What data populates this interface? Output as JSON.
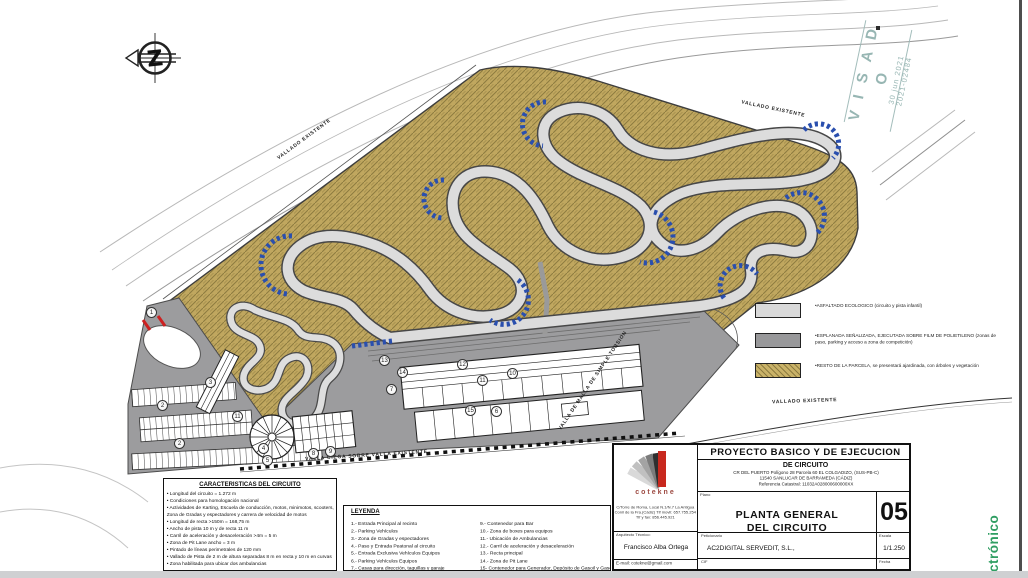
{
  "stamp": {
    "title": "V I S A D O",
    "date": "30 jun 2021",
    "number": "2021-02484"
  },
  "side_text": "ctrónico",
  "fence_labels": {
    "top_left": "VALLADO  EXISTENTE",
    "top_right": "VALLADO  EXISTENTE",
    "right": "VALLADO  EXISTENTE",
    "diagonal": "VALLA  DE  MALLA  DE  SIMPLE  TORSION",
    "bottom": "VALLA  CIEGA  SOBRE  VALLA  EXISTENTE"
  },
  "characteristics": {
    "title": "CARACTERISTICAS DEL CIRCUITO",
    "items": [
      "• Longitud del circuito = 1.272 m",
      "• Condiciones para homologación nacional",
      "• Actividades de Karting, Escuela de conducción, motos, minimotos, scooters, Zona de Gradas y espectadores y carrera de velocidad de motos",
      "• Longitud de recta >150m = 168,75 m",
      "• Ancho de pista 10 m y de recta 11 m",
      "• Carril de aceleración y desaceleración >4m = 5 m",
      "• Zona de Pit Lane ancho = 3 m",
      "• Pintado de líneas perimetrales de 120 mm",
      "• Vallado de Pista de 2 m de altura separadas 8 m en recta y 10 m en curvas",
      "• Zona habilitada para ubicar dos ambulancias"
    ]
  },
  "leyenda": {
    "title": "LEYENDA",
    "left": [
      "1.- Entrada Principal al recinto",
      "2.- Parking Vehículos",
      "3.- Zona de Gradas y espectadores",
      "4.- Paso y Entrada Peatonal al circuito",
      "5.- Entrada Exclusiva Vehículos Equipos",
      "6.- Parking Vehículos Equipos",
      "7.- Casas para dirección, taquillas y garaje",
      "8.- Contenedor para Aseos"
    ],
    "right": [
      "9.- Contenedor para Bar",
      "10.- Zona de boxes para equipos",
      "11.- Ubicación de Ambulancias",
      "12.- Carril de aceleración y desaceleración",
      "13.- Recta principal",
      "14.- Zona de Pit Lane",
      "15- Contenedor para Generador, Depósito de Gasoil y Gasolina"
    ]
  },
  "surface_legend": {
    "items": [
      {
        "type": "light",
        "label": "•ASFALTADO ECOLOGICO (circuito y pista infantil)"
      },
      {
        "type": "dark",
        "label": "•ESPLANADA SEÑALIZADA, EJECUTADA SOBRE FILM DE POLIETILENO (zonas de paso, parking y acceso a zona de competición)"
      },
      {
        "type": "hatch",
        "label": "•RESTO DE LA PARCELA, se presentará ajardinada, con árboles y vegetación"
      }
    ]
  },
  "titleblock": {
    "project_title": "PROYECTO BASICO Y DE EJECUCION",
    "project_subtitle": "DE CIRCUITO",
    "address_line1": "CR DEL PUERTO Polígono 28 Parcela 60 EL COLGADIZO, (SUS-PB-C)",
    "address_line2": "11540 SANLUCAR DE BARRAMEDA (CÁDIZ)",
    "address_line3": "Referencia Catastral: 11032A028000600000XX",
    "plano_label": "Plano",
    "sheet_title_line1": "PLANTA GENERAL",
    "sheet_title_line2": "DEL CIRCUITO",
    "sheet_number": "05",
    "peticionario_label": "Peticionario",
    "peticionario": "AC2DIGITAL SERVEDIT, S.L.,",
    "cif_label": "CIF",
    "cif": "B-72,170,889",
    "escala_label": "Escala",
    "escala": "1/1.250",
    "fecha_label": "Fecha",
    "fecha": "Junio 2021",
    "firm": {
      "name": "cotekne",
      "address": "C/Torre de Roma, Local N.1/N.7 La Antigua Conil de la Fra.(Cádiz) Tlf movil: 657.755.254 Tlf y fax: 856.445.921",
      "role_label": "Arquitecto Técnico:",
      "architect": "Francisco Alba Ortega",
      "email": "E-mail: cotekne@gmail.com"
    }
  },
  "markers": [
    {
      "n": "1",
      "x": 152,
      "y": 313
    },
    {
      "n": "2",
      "x": 163,
      "y": 406
    },
    {
      "n": "2",
      "x": 180,
      "y": 444
    },
    {
      "n": "3",
      "x": 211,
      "y": 383
    },
    {
      "n": "11",
      "x": 238,
      "y": 417
    },
    {
      "n": "4",
      "x": 264,
      "y": 449
    },
    {
      "n": "5",
      "x": 268,
      "y": 461
    },
    {
      "n": "8",
      "x": 314,
      "y": 454
    },
    {
      "n": "9",
      "x": 331,
      "y": 452
    },
    {
      "n": "13",
      "x": 385,
      "y": 361
    },
    {
      "n": "14",
      "x": 403,
      "y": 373
    },
    {
      "n": "7",
      "x": 392,
      "y": 390
    },
    {
      "n": "12",
      "x": 463,
      "y": 365
    },
    {
      "n": "11",
      "x": 483,
      "y": 381
    },
    {
      "n": "15",
      "x": 471,
      "y": 411
    },
    {
      "n": "6",
      "x": 497,
      "y": 412
    },
    {
      "n": "10",
      "x": 513,
      "y": 374
    }
  ]
}
